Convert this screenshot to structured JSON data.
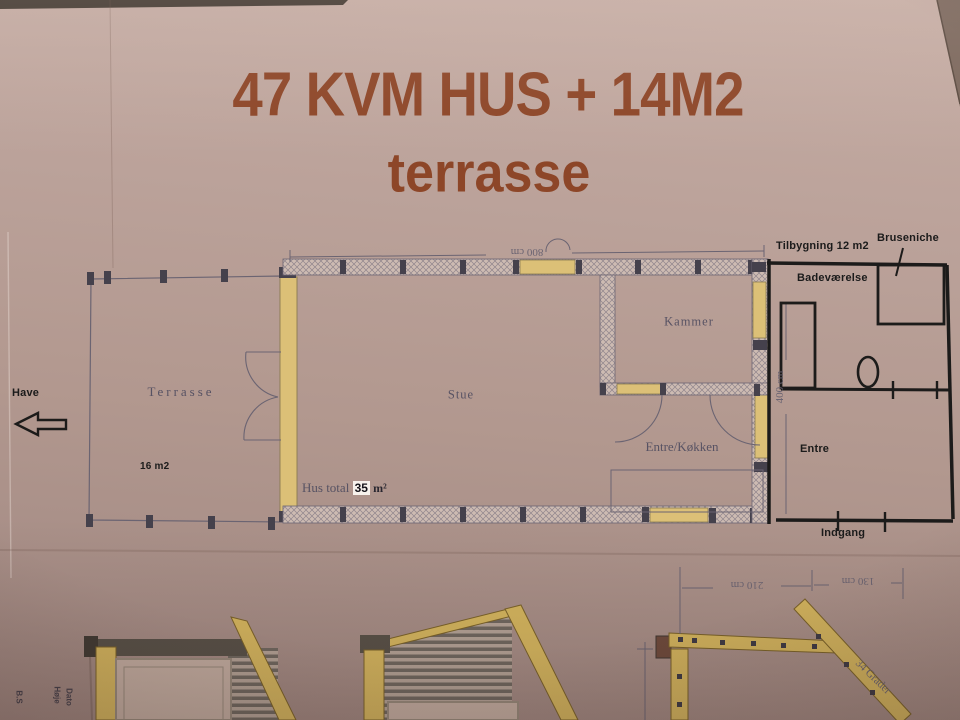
{
  "title": {
    "line1": "47 KVM HUS + 14M2",
    "line2": "terrasse"
  },
  "plan": {
    "rooms": {
      "terrasse": "Terrasse",
      "stue": "Stue",
      "kammer": "Kammer",
      "entre_koekken": "Entre/Køkken"
    },
    "areas": {
      "terrasse_area": "16 m2"
    },
    "hus_total": {
      "prefix": "Hus total",
      "value": "35",
      "unit": "m²"
    },
    "dimensions": {
      "width": "800 cm",
      "depth": "400 cm"
    }
  },
  "addition": {
    "title": "Tilbygning 12 m2",
    "labels": {
      "bruseniche": "Bruseniche",
      "badevaerelse": "Badeværelse",
      "entre": "Entre",
      "indgang": "Indgang"
    }
  },
  "site": {
    "garden": "Have"
  },
  "elevation": {
    "dim_upper": "210 cm",
    "dim_lower": "130 cm",
    "roof_angle": "34 Grader"
  },
  "margin_notes": {
    "note1": "Høje",
    "note2": "Dato",
    "note3": "B.S"
  },
  "colors": {
    "title_text": "#8d4628",
    "plan_lines": "#6b6472",
    "marker_lines": "#1c1b1a",
    "wood_yellow": "#dcc077",
    "paper": "#b49b94"
  }
}
